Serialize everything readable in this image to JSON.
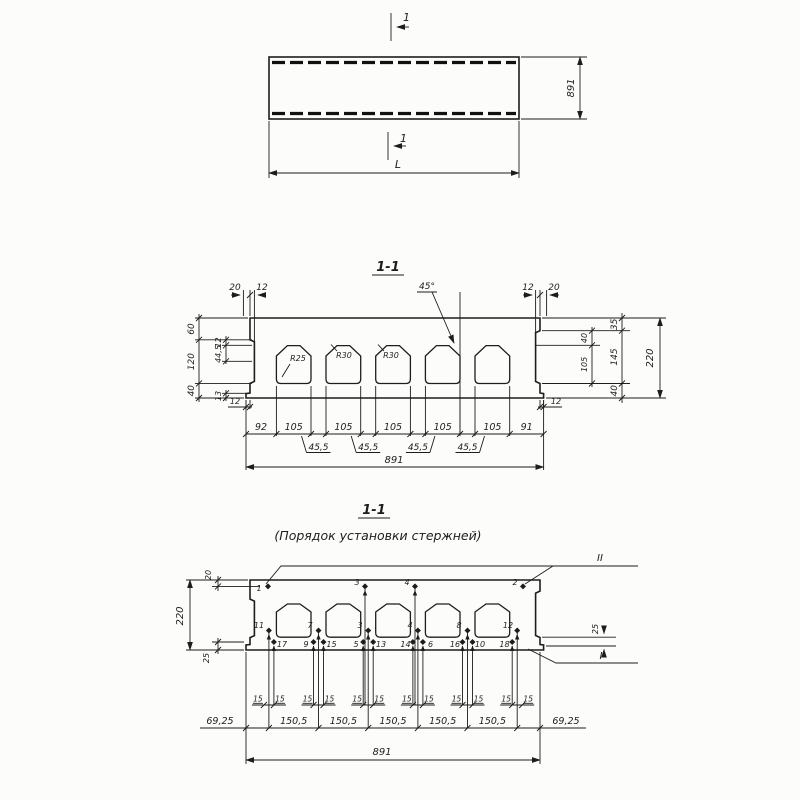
{
  "drawing": {
    "plan": {
      "mark_top": "1",
      "mark_bottom": "1",
      "length": "L",
      "width": "891"
    },
    "section": {
      "title": "1-1",
      "angle": "45°",
      "r_small": "R25",
      "r_big": "R30",
      "top_left": [
        "20",
        "12"
      ],
      "top_right": [
        "12",
        "20"
      ],
      "left_chain": [
        "60",
        "120",
        "40"
      ],
      "left_inner": [
        "12",
        "44,5",
        "13"
      ],
      "lip_left": "12",
      "lip_right": "12",
      "right_inner": [
        "40",
        "105"
      ],
      "right_chain": [
        "35",
        "145",
        "40"
      ],
      "height_total": "220",
      "chain": [
        "92",
        "105",
        "105",
        "105",
        "105",
        "105",
        "91"
      ],
      "half_step": "45,5",
      "width_total": "891"
    },
    "order": {
      "title": "1-1",
      "subtitle": "(Порядок  установки  стержней)",
      "group_top": "II",
      "group_bottom": "I",
      "cover_top": "20",
      "height_total": "220",
      "cover_bottom": "25",
      "offset_right": "25",
      "top_rods": [
        "1",
        "3",
        "4",
        "2"
      ],
      "mid_rods": [
        "11",
        "7",
        "3",
        "4",
        "8",
        "12"
      ],
      "bottom_rods": [
        "17",
        "9",
        "15",
        "5",
        "13",
        "14",
        "6",
        "16",
        "10",
        "18"
      ],
      "pair_spacing": "15",
      "edge_step": "69,25",
      "step": "150,5",
      "width_total": "891"
    }
  }
}
